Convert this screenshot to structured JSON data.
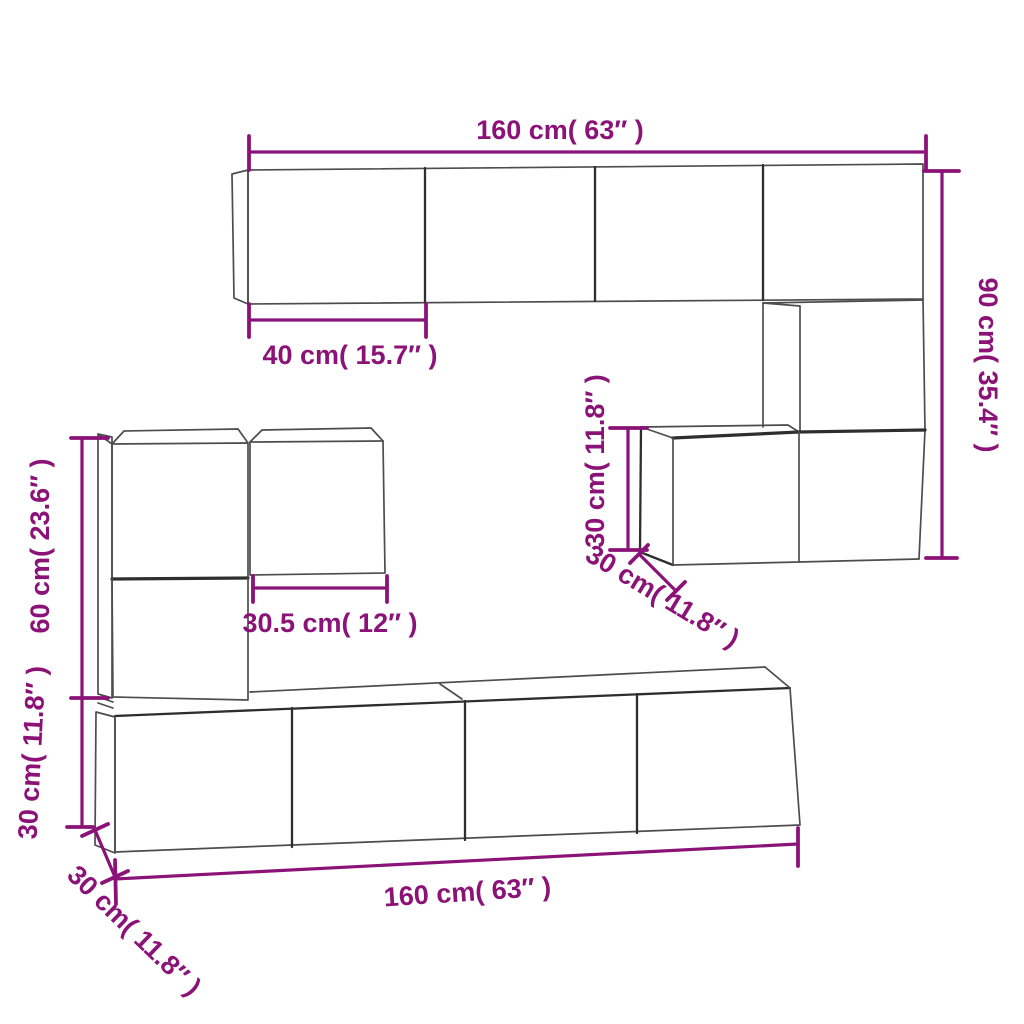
{
  "page": {
    "background": "#ffffff"
  },
  "diagram": {
    "type": "product-dimension-diagram",
    "subject": "wall-mounted-tv-cabinet-set",
    "colors": {
      "dimension_annotation": "#8B1378",
      "cabinet_line": "#4d4d4d",
      "cabinet_line_dark": "#2e2e2e",
      "background": "#ffffff"
    },
    "dimensions": {
      "top_cabinet_width": {
        "label": "160 cm( 63″ )",
        "value_cm": 160,
        "value_in": 63
      },
      "top_cabinet_door_width": {
        "label": "40 cm( 15.7″ )",
        "value_cm": 40,
        "value_in": 15.7
      },
      "right_column_height": {
        "label": "90 cm( 35.4″ )",
        "value_cm": 90,
        "value_in": 35.4
      },
      "middle_box_height": {
        "label": "30 cm( 11.8″ )",
        "value_cm": 30,
        "value_in": 11.8
      },
      "middle_box_depth": {
        "label": "30 cm( 11.8″ )",
        "value_cm": 30,
        "value_in": 11.8
      },
      "left_column_height": {
        "label": "60 cm( 23.6″ )",
        "value_cm": 60,
        "value_in": 23.6
      },
      "left_upper_box_width": {
        "label": "30.5 cm( 12″ )",
        "value_cm": 30.5,
        "value_in": 12
      },
      "bottom_cabinet_height": {
        "label": "30 cm( 11.8″ )",
        "value_cm": 30,
        "value_in": 11.8
      },
      "bottom_cabinet_depth": {
        "label": "30 cm( 11.8″ )",
        "value_cm": 30,
        "value_in": 11.8
      },
      "bottom_cabinet_width": {
        "label": "160 cm( 63″ )",
        "value_cm": 160,
        "value_in": 63
      }
    }
  }
}
